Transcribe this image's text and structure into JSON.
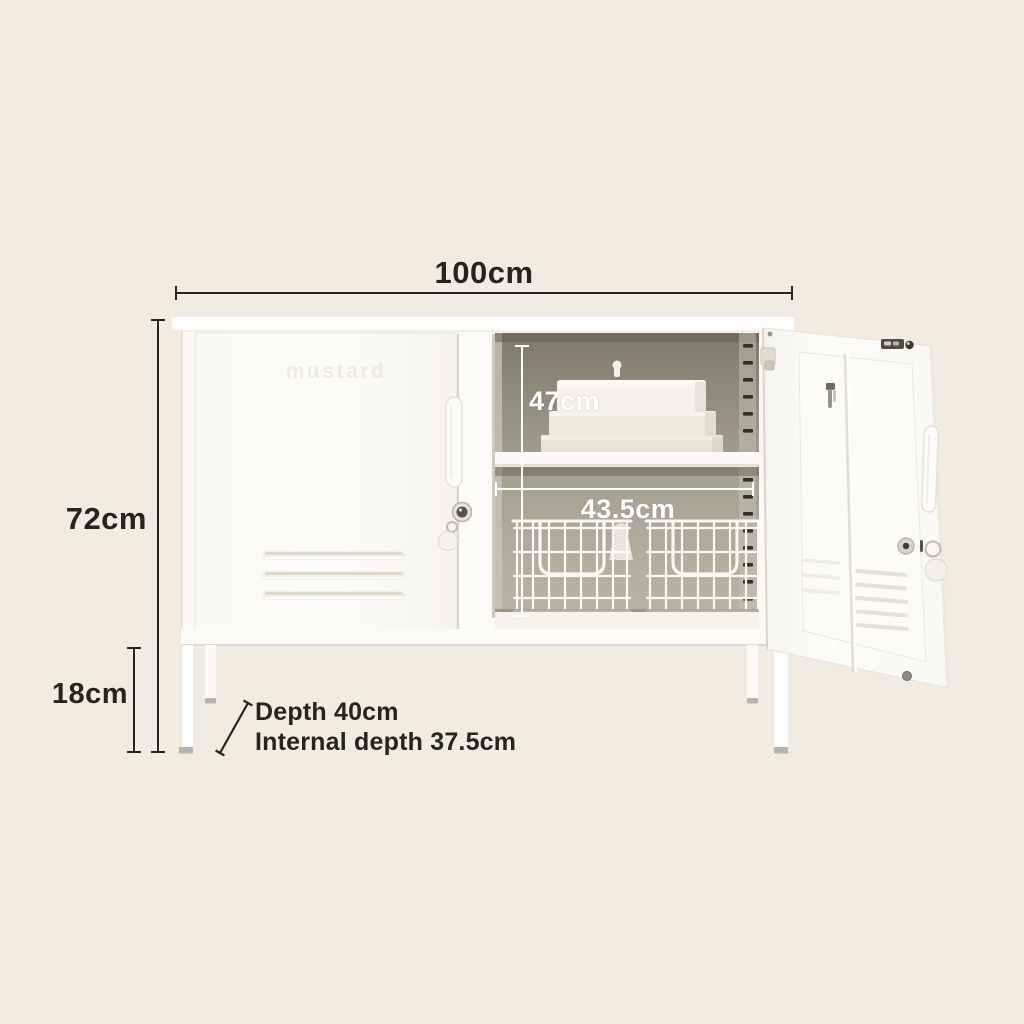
{
  "annotations": {
    "width_label": "100cm",
    "height_label": "72cm",
    "leg_height_label": "18cm",
    "internal_height_label": "47cm",
    "internal_width_label": "43.5cm",
    "depth_label_line1": "Depth 40cm",
    "depth_label_line2": "Internal depth 37.5cm"
  },
  "cabinet": {
    "brand_emboss": "mustard"
  },
  "colors": {
    "background": "#f1ecdf",
    "annotation_ink": "#26241e",
    "annotation_light": "#ffffff",
    "cabinet_white": "#fdfcf9",
    "interior_olive": "#a39e8d",
    "metal_grey": "#c6c2b4"
  }
}
